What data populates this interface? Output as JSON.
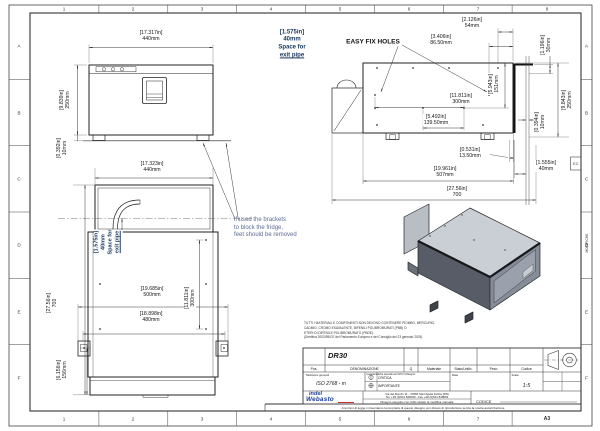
{
  "sheet": {
    "cols": [
      "1",
      "2",
      "3",
      "4",
      "5",
      "6",
      "7",
      "8"
    ],
    "bottom_cols": [
      "1",
      "2",
      "3",
      "4",
      "5",
      "6",
      "7"
    ],
    "rows": [
      "A",
      "B",
      "C",
      "D",
      "E",
      "F"
    ],
    "format": "A3"
  },
  "dims": {
    "front_width": {
      "in": "[17.317in]",
      "mm": "440mm"
    },
    "front_height": {
      "in": "[9.839in]",
      "mm": "250mm"
    },
    "front_foot": {
      "in": "[0.392in]",
      "mm": "10mm"
    },
    "side_hole_a": {
      "in": "[2.126in]",
      "mm": "54mm"
    },
    "side_hole_b": {
      "in": "[3.406in]",
      "mm": "86.50mm"
    },
    "side_top_gap": {
      "in": "[1.196in]",
      "mm": "30mm"
    },
    "side_hole_h": {
      "in": "[5.943in]",
      "mm": "151mm"
    },
    "side_hole_span": {
      "in": "[11.811in]",
      "mm": "300mm"
    },
    "side_hole_span2": {
      "in": "[5.492in]",
      "mm": "139.50mm"
    },
    "side_wall": {
      "in": "[0.394in]",
      "mm": "10mm"
    },
    "side_height": {
      "in": "[9.843in]",
      "mm": "250mm"
    },
    "side_foot_off": {
      "in": "[0.531in]",
      "mm": "13.50mm"
    },
    "side_depth": {
      "in": "[19.961in]",
      "mm": "507mm"
    },
    "side_total": {
      "in": "[27.56in]",
      "mm": "700"
    },
    "side_rear_space": {
      "in": "[1.555in]",
      "mm": "40mm"
    },
    "top_width": {
      "in": "[17.323in]",
      "mm": "440mm"
    },
    "top_total": {
      "in": "[27.56in]",
      "mm": "700"
    },
    "top_hole_span": {
      "in": "[11.811in]",
      "mm": "300mm"
    },
    "top_bracket_w": {
      "in": "[19.685in]",
      "mm": "500mm"
    },
    "top_bracket_w2": {
      "in": "[18.898in]",
      "mm": "480mm"
    },
    "top_front_depth": {
      "in": "[6.156in]",
      "mm": "156mm"
    }
  },
  "notes": {
    "space": {
      "l1": "[1.575in]",
      "l2": "40mm",
      "l3": "Space for",
      "l4": "exit pipe"
    },
    "easy_fix": "EASY FIX HOLES",
    "bracket": {
      "l1": "if used the brackets",
      "l2": "to block the fridge,",
      "l3": "feet should be removed"
    },
    "rohs": {
      "l1": "TUTTI I MATERIALI E COMPONENTI NON DEVONO CONTENERE PIOMBO, MERCURIO,",
      "l2": "CADMIO, CROMO ESAVALENTE, BIFENILI POLIBROMURATI (PBB) O",
      "l3": "ETERI DI DIFENILE POLIBROMURATO (PBDE).",
      "l4": "(Direttiva 2002/95/CE del Parlamento Europeo e del Consiglio del 23 gennaio 2003)"
    }
  },
  "title_block": {
    "title": "DR30",
    "headers": [
      "Pos.",
      "DENOMINAZIONE",
      "Q",
      "Materiale",
      "Stato/Unific.",
      "Peso",
      "Codice"
    ],
    "tolerance_label": "Tolleranze generali",
    "tolerance_value": "ISO 2768 - m",
    "special_label": "Caratteristiche speciali e/o KPC's Disegno:",
    "critical": "CRITICA",
    "important": "IMPORTANTE",
    "date_label": "Data",
    "scale_label": "Scala",
    "scale_value": "1:5",
    "company_line1": "indel",
    "company_line2": "Webasto",
    "address_line1": "Via dei Ronchi 11 - 47866 Sant'Agata Feltria (RN)",
    "address_line2": "Tel. +39 (0)541 848030 - Fax +39 (0)541 848563",
    "cad_note": "Disegno eseguito con CAD vietato la modifica manuale",
    "codice_label": "CODICE",
    "legal": "A termini di legge ci riserviamo la proprietà di questo disegno con divieto di riproduzione senza la nostra autorizzazione",
    "modifiche": "MODIFICHE",
    "ec": "EC"
  }
}
